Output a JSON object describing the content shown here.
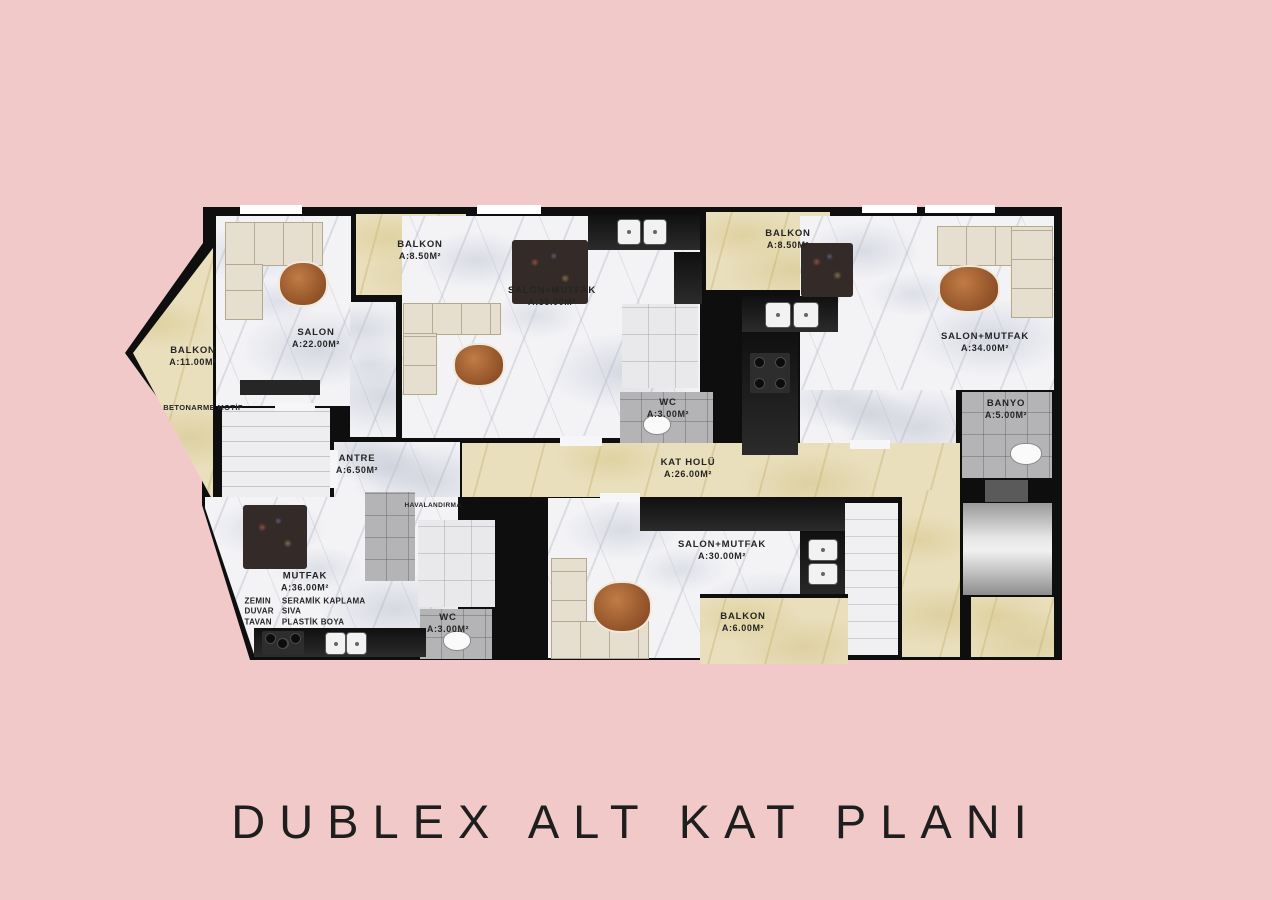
{
  "title": "DUBLEX ALT KAT PLANI",
  "colors": {
    "background": "#f1c9c9",
    "walls": "#0e0e0e",
    "white_marble": "#f3f3f6",
    "beige_marble": "#e9dfbd",
    "gray_tile": "#b4b4b6",
    "silver": "#c9c9c9",
    "wood_table": "#a9653a",
    "title_text": "#1e1e1e"
  },
  "plan": {
    "rooms": {
      "salon": {
        "name": "SALON",
        "area": "A:22.00M²"
      },
      "balkon_top": {
        "name": "BALKON",
        "area": "A:8.50M²"
      },
      "salon_mutfak_mid": {
        "name": "SALON+MUTFAK",
        "area": "A:35.00M²"
      },
      "balkon_right_top": {
        "name": "BALKON",
        "area": "A:8.50M²"
      },
      "salon_mutfak_right": {
        "name": "SALON+MUTFAK",
        "area": "A:34.00M²"
      },
      "banyo": {
        "name": "BANYO",
        "area": "A:5.00M²"
      },
      "balkon_left": {
        "name": "BALKON",
        "area": "A:11.00M²"
      },
      "betonarme": {
        "name": "BETONARME MOTİF"
      },
      "antre": {
        "name": "ANTRE",
        "area": "A:6.50M²"
      },
      "wc_mid": {
        "name": "WC",
        "area": "A:3.00M²"
      },
      "kat_holu": {
        "name": "KAT HOLÜ",
        "area": "A:26.00M²"
      },
      "havalandirma": {
        "name": "HAVALANDIRMA"
      },
      "mutfak": {
        "name": "MUTFAK",
        "area": "A:36.00M²"
      },
      "wc_bottom": {
        "name": "WC",
        "area": "A:3.00M²"
      },
      "salon_mutfak_bottom": {
        "name": "SALON+MUTFAK",
        "area": "A:30.00M²"
      },
      "balkon_bottom": {
        "name": "BALKON",
        "area": "A:6.00M²"
      }
    },
    "finishes": {
      "rows": [
        [
          "ZEMIN",
          "SERAMİK KAPLAMA"
        ],
        [
          "DUVAR",
          "SIVA"
        ],
        [
          "TAVAN",
          "PLASTİK BOYA"
        ]
      ]
    }
  }
}
